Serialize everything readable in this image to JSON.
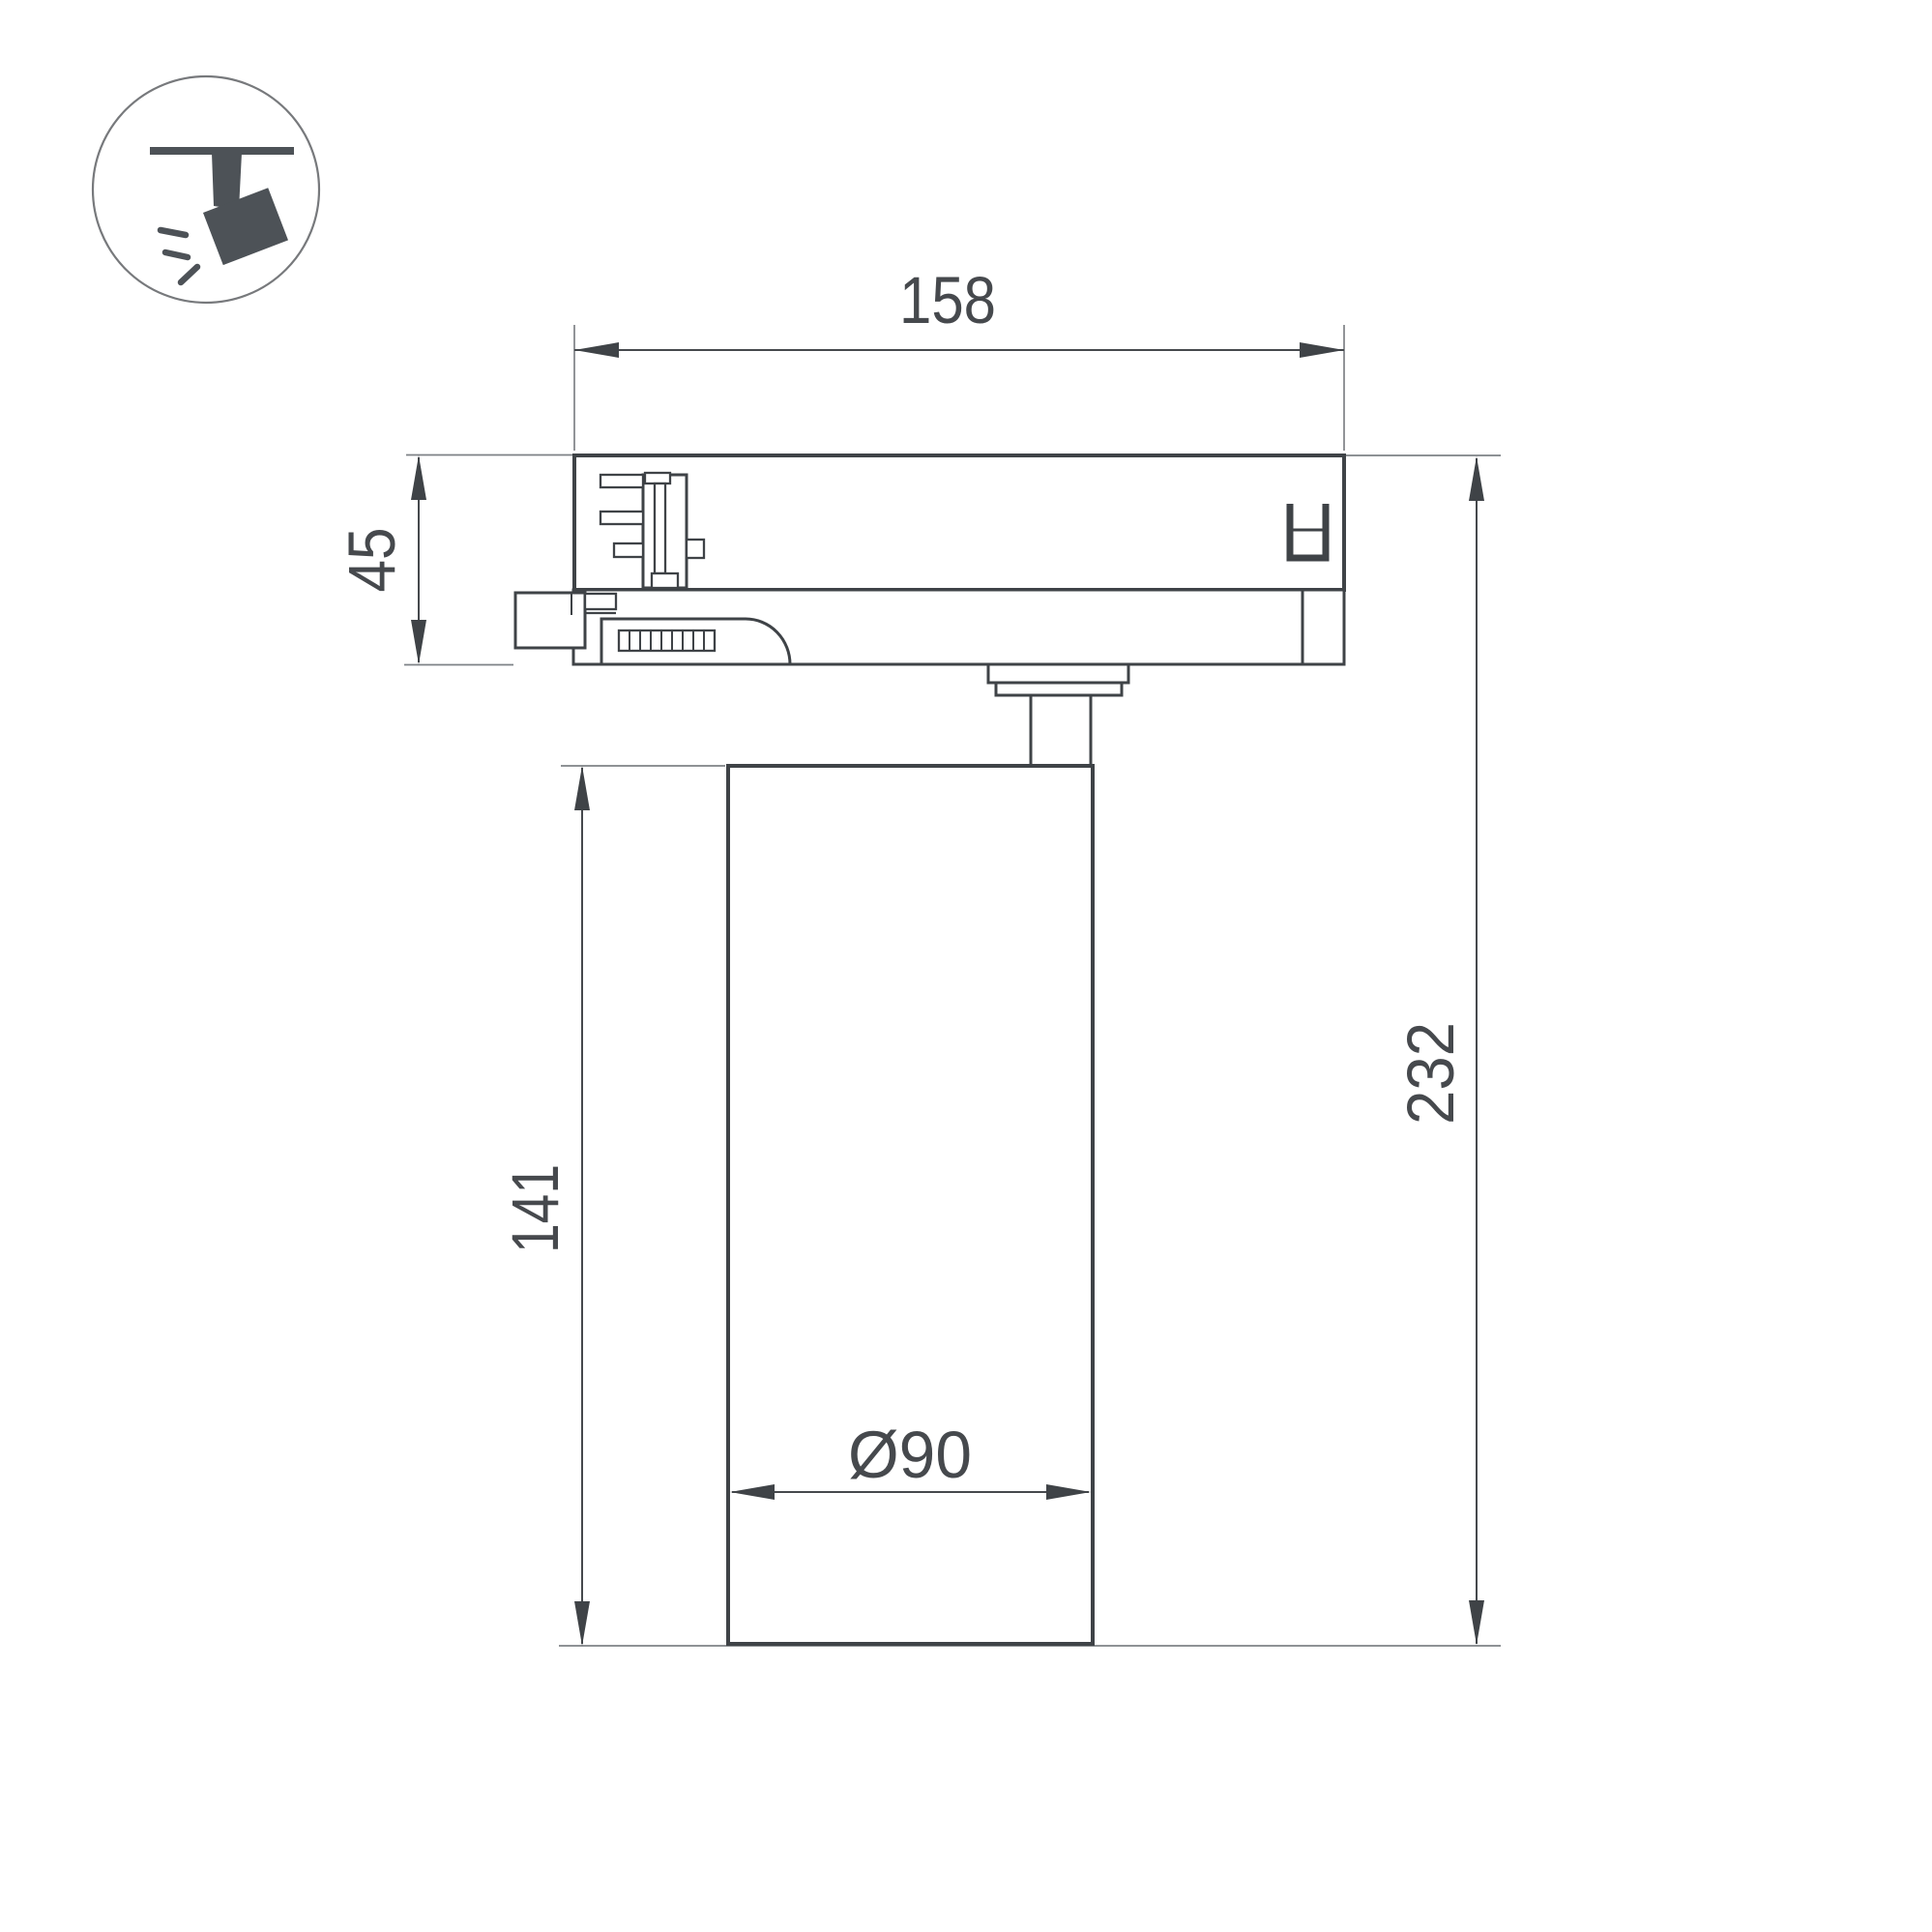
{
  "meta": {
    "background": "#ffffff",
    "subject": "Track-mounted spotlight, dimensioned side elevation drawing"
  },
  "icon": {
    "name": "track-spotlight-icon",
    "glyph_color": "#4d5257",
    "circle_color": "#77797c"
  },
  "style": {
    "line_color": "#3f4347",
    "dimension_line_color": "#46494d",
    "extension_line_color": "#7e8286",
    "text_color": "#46494d"
  },
  "dimensions": {
    "adapter_width": "158",
    "adapter_height": "45",
    "lamp_body_height": "141",
    "overall_height": "232",
    "lamp_body_diameter": "Ø90"
  }
}
